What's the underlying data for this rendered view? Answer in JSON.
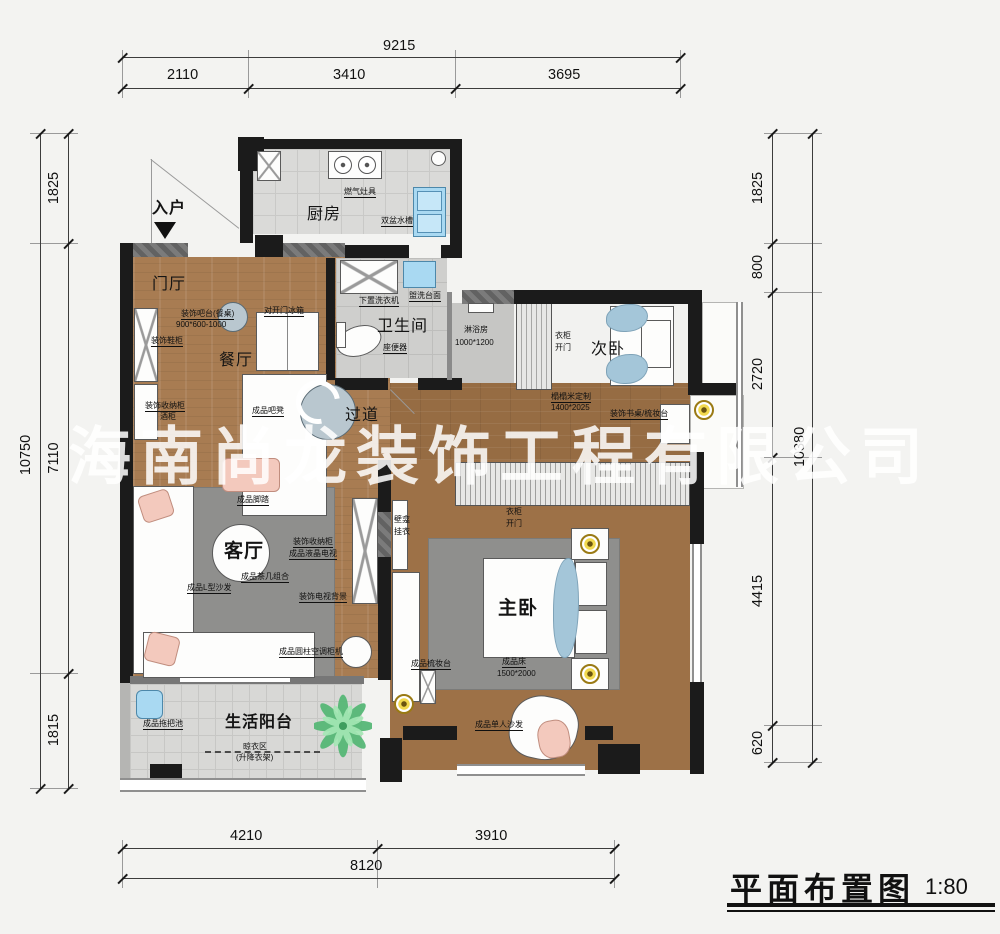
{
  "title_block": {
    "title": "平面布置图",
    "scale": "1:80"
  },
  "watermark": "海南尚龙装饰工程有限公司",
  "entry": {
    "label": "入户"
  },
  "dims": {
    "top": {
      "total": "9215",
      "segments": [
        "2110",
        "3410",
        "3695"
      ]
    },
    "left": {
      "total": "10750",
      "segments": [
        "1825",
        "7110",
        "1815"
      ]
    },
    "right": {
      "total": "10380",
      "segments": [
        "1825",
        "800",
        "2720",
        "4415",
        "620"
      ]
    },
    "bottom": {
      "total": "8120",
      "segments": [
        "4210",
        "3910"
      ]
    }
  },
  "rooms": {
    "kitchen": "厨房",
    "foyer": "门厅",
    "dining": "餐厅",
    "bath": "卫生间",
    "shower": "淋浴房",
    "bedroom2": "次卧",
    "hall": "过道",
    "living": "客厅",
    "master": "主卧",
    "balcony": "生活阳台"
  },
  "annotations": {
    "gas_stove": "燃气灶具",
    "double_sink": "双盆水槽",
    "bar_table": "装饰吧台(餐桌)",
    "bar_table_size": "900*600-1000",
    "fridge": "对开门冰箱",
    "shoe_cabinet": "装饰鞋柜",
    "storage_cabinet": "装饰收纳柜",
    "wine_cabinet": "酒柜",
    "bar_stool": "成品吧凳",
    "washer": "下置洗衣机",
    "wash_counter": "盥洗台面",
    "toilet": "座便器",
    "shower_size": "1000*1200",
    "wardrobe2": "衣柜",
    "wardrobe2_open": "开门",
    "tatami": "榻榻米定制",
    "tatami_size": "1400*2025",
    "desk": "装饰书桌/梳妆台",
    "ottoman": "成品脚踏",
    "storage_cabinet2": "装饰收纳柜",
    "tv": "成品液晶电视",
    "tea_table": "成品茶几组合",
    "sofa_l": "成品L型沙发",
    "tv_wall": "装饰电视背景",
    "ac": "成品圆柱空调柜机",
    "niche": "壁龛",
    "hang": "挂衣",
    "wardrobe_m": "衣柜",
    "wardrobe_m_open": "开门",
    "dresser": "成品梳妆台",
    "bed": "成品床",
    "bed_size": "1500*2000",
    "single_sofa": "成品单人沙发",
    "mop_sink": "成品拖把池",
    "drying": "晾衣区",
    "drying_sub": "(升降衣架)"
  }
}
